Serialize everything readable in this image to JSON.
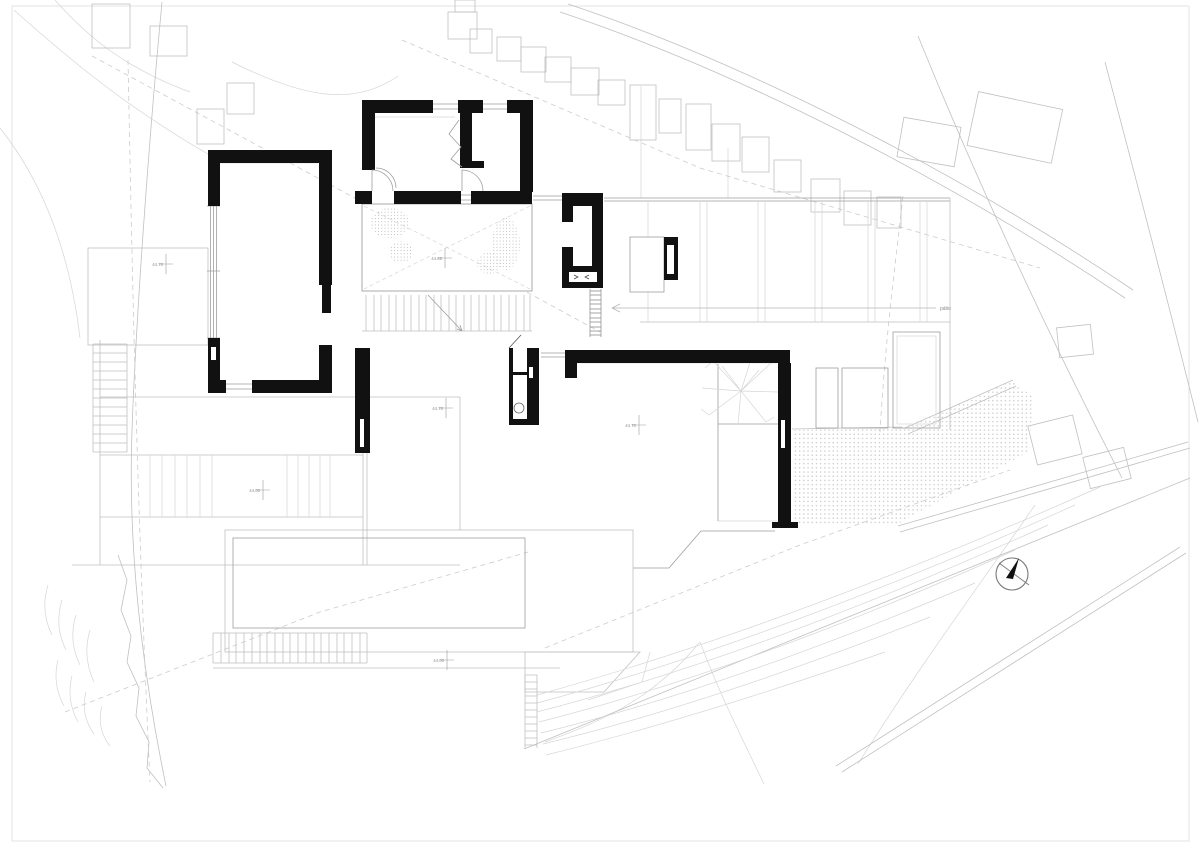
{
  "labels": {
    "patio": "pátio"
  },
  "levels": [
    {
      "value": "44.70"
    },
    {
      "value": "44.65"
    },
    {
      "value": "44.70"
    },
    {
      "value": "44.70"
    },
    {
      "value": "44.00"
    },
    {
      "value": "44.00"
    }
  ],
  "icons": {
    "north_arrow": "north-arrow-icon"
  },
  "colors": {
    "ink": "#111111",
    "paper": "#ffffff",
    "site_light": "#d6d6d6",
    "site_mid": "#c0c0c0",
    "outline": "#9e9e9e",
    "annotation": "#8f8f8f"
  }
}
